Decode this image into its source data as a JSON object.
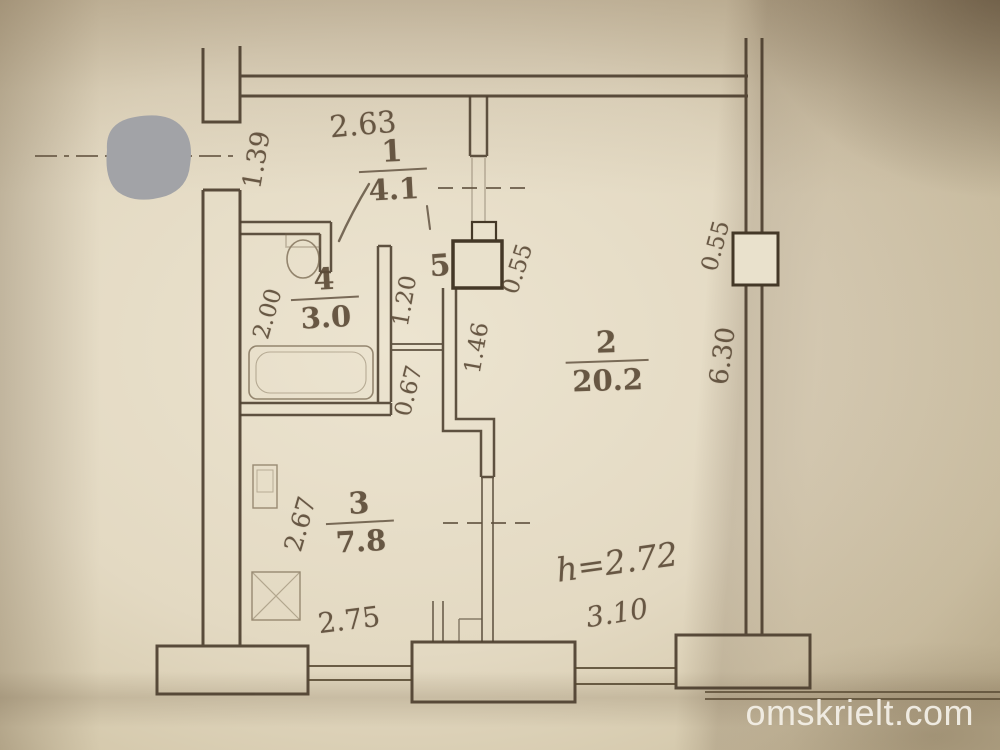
{
  "watermark": "omskrielt.com",
  "rooms": {
    "r1": {
      "number": "1",
      "area": "4.1"
    },
    "r2": {
      "number": "2",
      "area": "20.2"
    },
    "r3": {
      "number": "3",
      "area": "7.8"
    },
    "r4": {
      "number": "4",
      "area": "3.0"
    },
    "r5": {
      "number": "5"
    }
  },
  "dimensions": {
    "corridor_width": "2.63",
    "entry_opening": "1.39",
    "bathroom_depth": "2.00",
    "hall_width": "1.20",
    "niche_depth": "1.46",
    "wall_segment": "0.67",
    "duct_hall": "0.55",
    "duct_wall": "0.55",
    "room2_depth": "6.30",
    "kitchen_depth": "2.67",
    "kitchen_width": "2.75",
    "balcony_width": "3.10",
    "ceiling_height": "h=2.72"
  }
}
